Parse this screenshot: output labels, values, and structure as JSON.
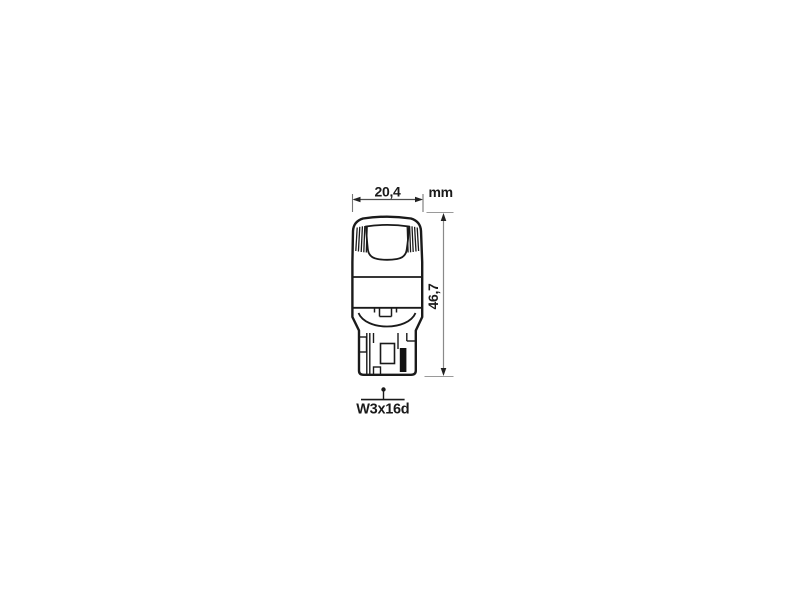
{
  "diagram": {
    "width_dimension": "20,4",
    "unit": "mm",
    "height_dimension": "46,7",
    "base_type": "W3x16d"
  },
  "colors": {
    "background": "#ffffff",
    "outline": "#1a1a1a",
    "dimension_line": "#555555",
    "extension_line": "#9a9a9a",
    "contact_fill": "#111111"
  }
}
